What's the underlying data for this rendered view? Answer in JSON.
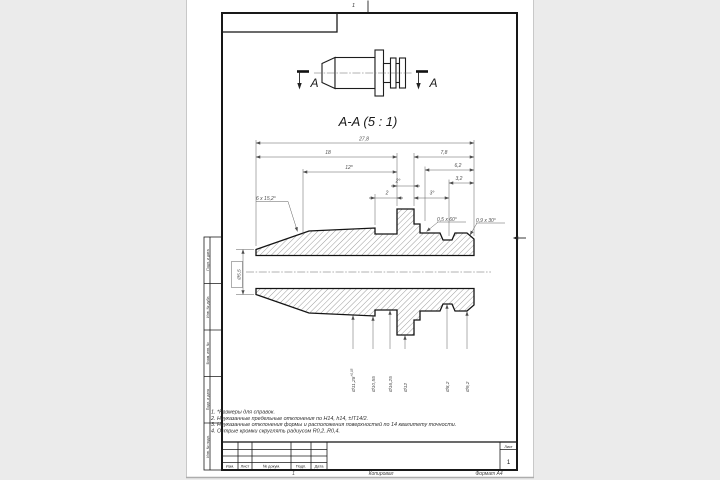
{
  "sheet": {
    "zone_mark_top": "1",
    "footer_mark": "1",
    "copied_label": "Копировал",
    "format_label": "Формат А4"
  },
  "views": {
    "cut_letter_left": "A",
    "cut_letter_right": "A",
    "section_title": "A-A (5 : 1)"
  },
  "dims": {
    "overall_length": "27,8",
    "left_length": "18",
    "right_length": "7,8",
    "ref_length": "12*",
    "flange_angle": "2°",
    "step_length": "2",
    "collar_angle": "3°",
    "collar_length": "6,2",
    "end_length": "3,2",
    "nose_chamfer": "6 x 15,2°",
    "collar_chamfer": "0,5 x 60°",
    "end_chamfer": "0,9 x 30°",
    "tip_diameter": "Ø5,5",
    "dia_1": "Ø11,28",
    "dia_1_tol": "+0,05",
    "dia_2": "Ø10,55",
    "dia_3": "Ø16,25",
    "dia_4": "Ø12",
    "dia_5": "Ø8,2",
    "dia_6": "Ø9,2"
  },
  "notes": {
    "line_1": "1. *Размеры для справок.",
    "line_2": "2. Неуказанные предельные отклонения по H14, h14, ±IT14/2.",
    "line_3": "3. Неуказанные отклонения формы и расположения поверхностей по 14 квалитету точности.",
    "line_4": "4. Острые кромки скруглять радиусом R0,2..R0,4."
  },
  "title_block": {
    "col_izm": "Изм.",
    "col_list": "Лист",
    "col_doc": "№ докум.",
    "col_podp": "Подп.",
    "col_data": "Дата",
    "sheet_label": "Лист",
    "sheet_value": "1"
  },
  "side_strip": {
    "items": [
      {
        "label": "Подп. и дата"
      },
      {
        "label": "Инв. № дубл."
      },
      {
        "label": "Взам. инв. №"
      },
      {
        "label": "Подп. и дата"
      },
      {
        "label": "Инв. № подл."
      }
    ]
  }
}
